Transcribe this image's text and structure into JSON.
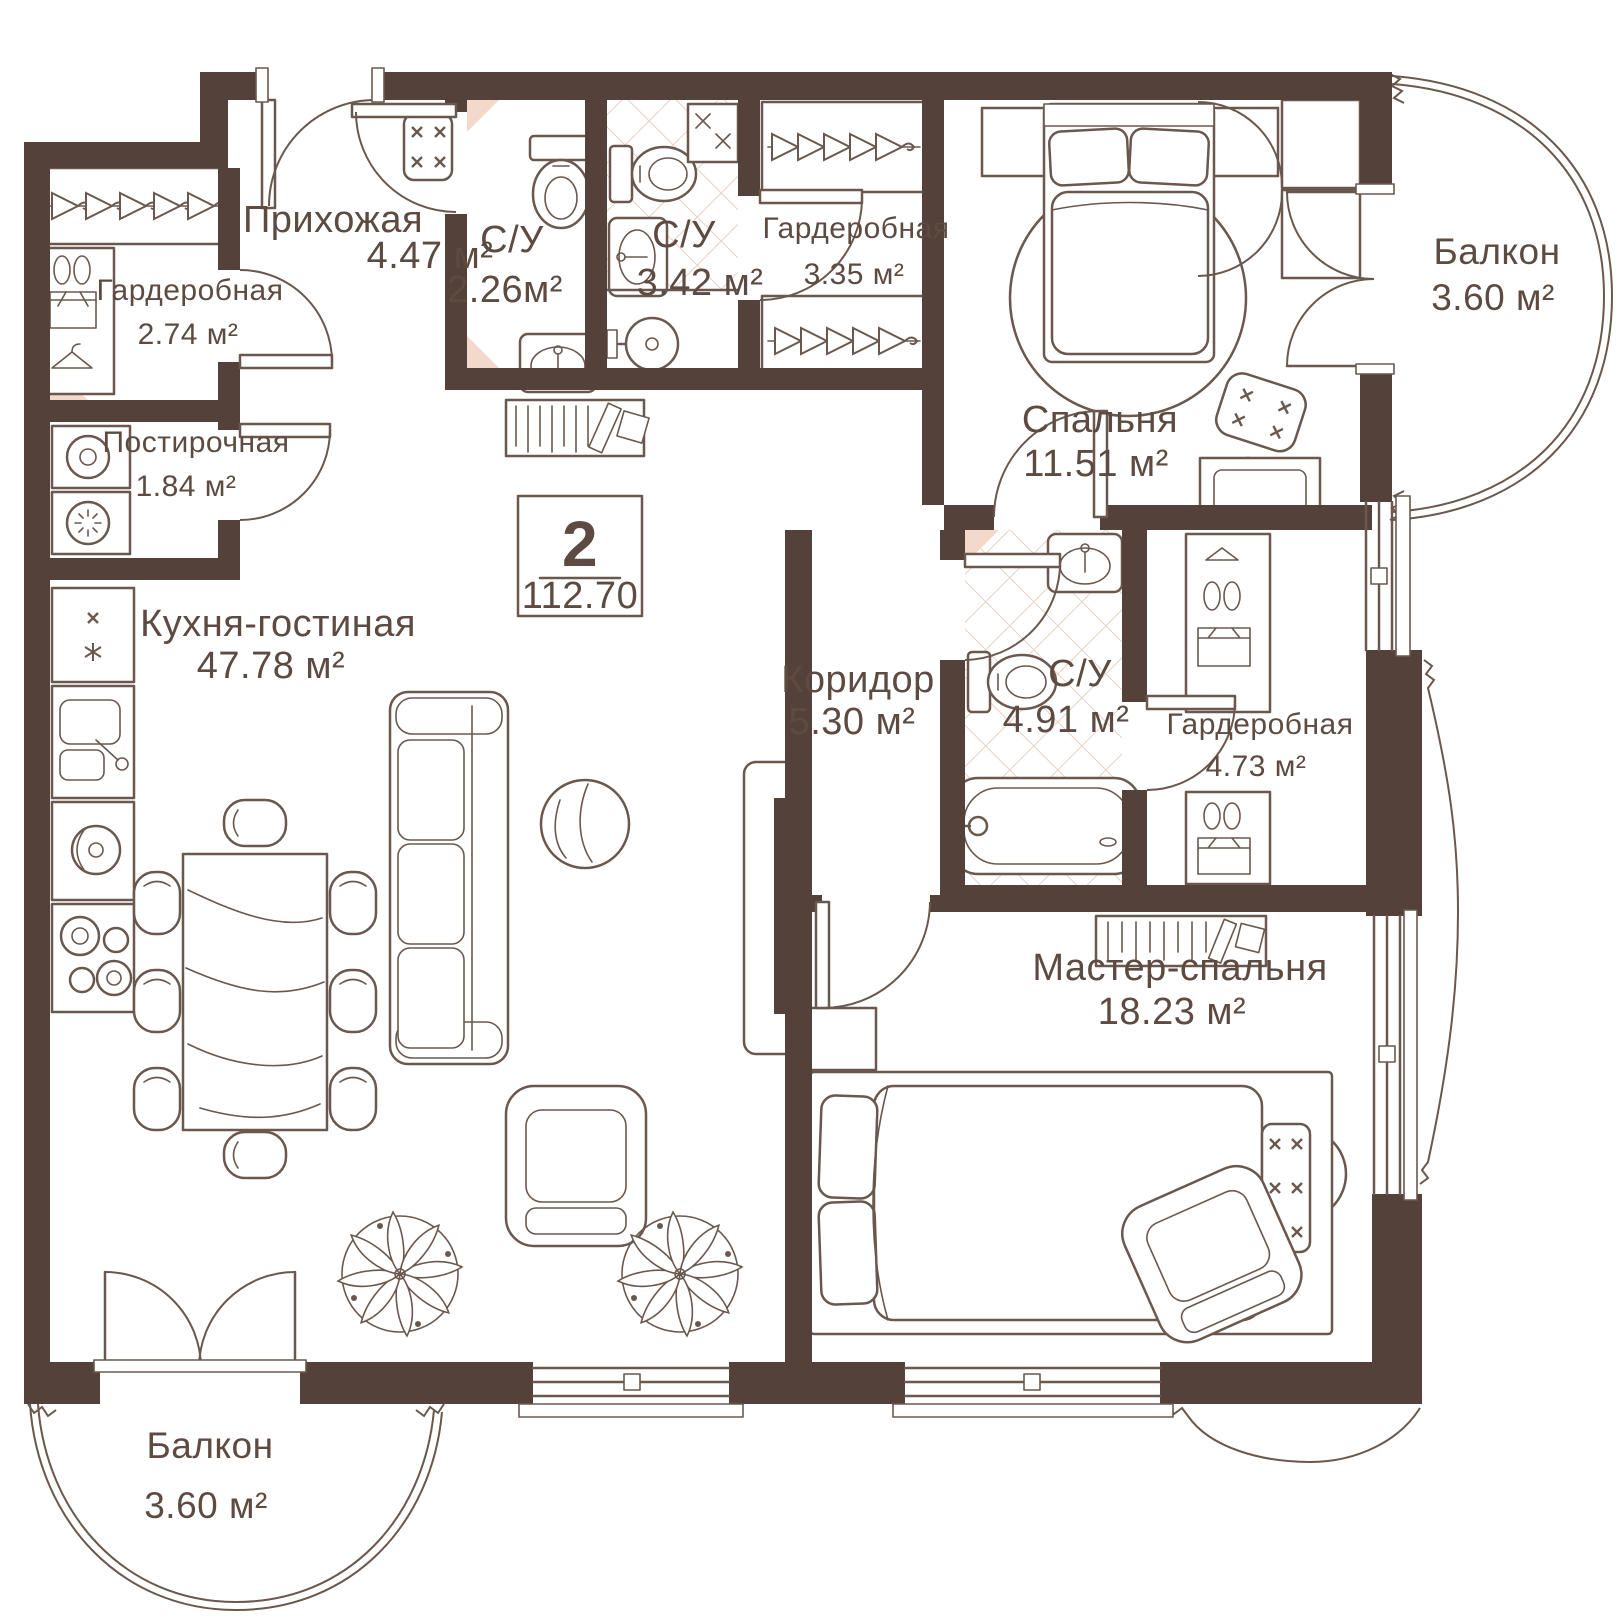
{
  "plan": {
    "wall_color": "#544139",
    "line_color": "#6a584e",
    "text_color": "#5d4b42",
    "accent_color": "#f3d9cc",
    "floor_pattern_color": "#e9d0c5",
    "unit_suffix": "м²"
  },
  "badge": {
    "rooms_count": "2",
    "total_area": "112.70"
  },
  "rooms": [
    {
      "id": "prihozhaya",
      "name": "Прихожая",
      "area": "4.47 м²",
      "fs": 38,
      "nx": 333,
      "ny": 232,
      "ax": 430,
      "ay": 268
    },
    {
      "id": "su-226",
      "name": "С/У",
      "area": "2.26м²",
      "fs": 38,
      "nx": 512,
      "ny": 252,
      "ax": 505,
      "ay": 302
    },
    {
      "id": "su-342",
      "name": "С/У",
      "area": "3.42 м²",
      "fs": 38,
      "nx": 684,
      "ny": 247,
      "ax": 700,
      "ay": 295
    },
    {
      "id": "garderobnaya-335",
      "name": "Гардеробная",
      "area": "3.35 м²",
      "fs": 30,
      "nx": 856,
      "ny": 238,
      "ax": 854,
      "ay": 284
    },
    {
      "id": "garderobnaya-274",
      "name": "Гардеробная",
      "area": "2.74 м²",
      "fs": 30,
      "nx": 190,
      "ny": 300,
      "ax": 188,
      "ay": 344
    },
    {
      "id": "postirochnaya",
      "name": "Постирочная",
      "area": "1.84 м²",
      "fs": 30,
      "nx": 196,
      "ny": 452,
      "ax": 186,
      "ay": 496
    },
    {
      "id": "spalnya",
      "name": "Спальня",
      "area": "11.51 м²",
      "fs": 38,
      "nx": 1100,
      "ny": 432,
      "ax": 1096,
      "ay": 476
    },
    {
      "id": "balkon-top",
      "name": "Балкон",
      "area": "3.60 м²",
      "fs": 37,
      "nx": 1497,
      "ny": 264,
      "ax": 1493,
      "ay": 310
    },
    {
      "id": "kuhnya-gostinaya",
      "name": "Кухня-гостиная",
      "area": "47.78 м²",
      "fs": 38,
      "nx": 278,
      "ny": 636,
      "ax": 271,
      "ay": 678
    },
    {
      "id": "koridor",
      "name": "Коридор",
      "area": "5.30 м²",
      "fs": 38,
      "nx": 858,
      "ny": 692,
      "ax": 852,
      "ay": 734
    },
    {
      "id": "su-491",
      "name": "С/У",
      "area": "4.91 м²",
      "fs": 38,
      "nx": 1080,
      "ny": 686,
      "ax": 1066,
      "ay": 732
    },
    {
      "id": "garderobnaya-473",
      "name": "Гардеробная",
      "area": "4.73 м²",
      "fs": 30,
      "nx": 1260,
      "ny": 734,
      "ax": 1256,
      "ay": 776
    },
    {
      "id": "master-spalnya",
      "name": "Мастер-спальня",
      "area": "18.23 м²",
      "fs": 38,
      "nx": 1180,
      "ny": 980,
      "ax": 1172,
      "ay": 1024
    },
    {
      "id": "balkon-bottom",
      "name": "Балкон",
      "area": "3.60 м²",
      "fs": 37,
      "nx": 210,
      "ny": 1458,
      "ax": 206,
      "ay": 1518
    }
  ]
}
